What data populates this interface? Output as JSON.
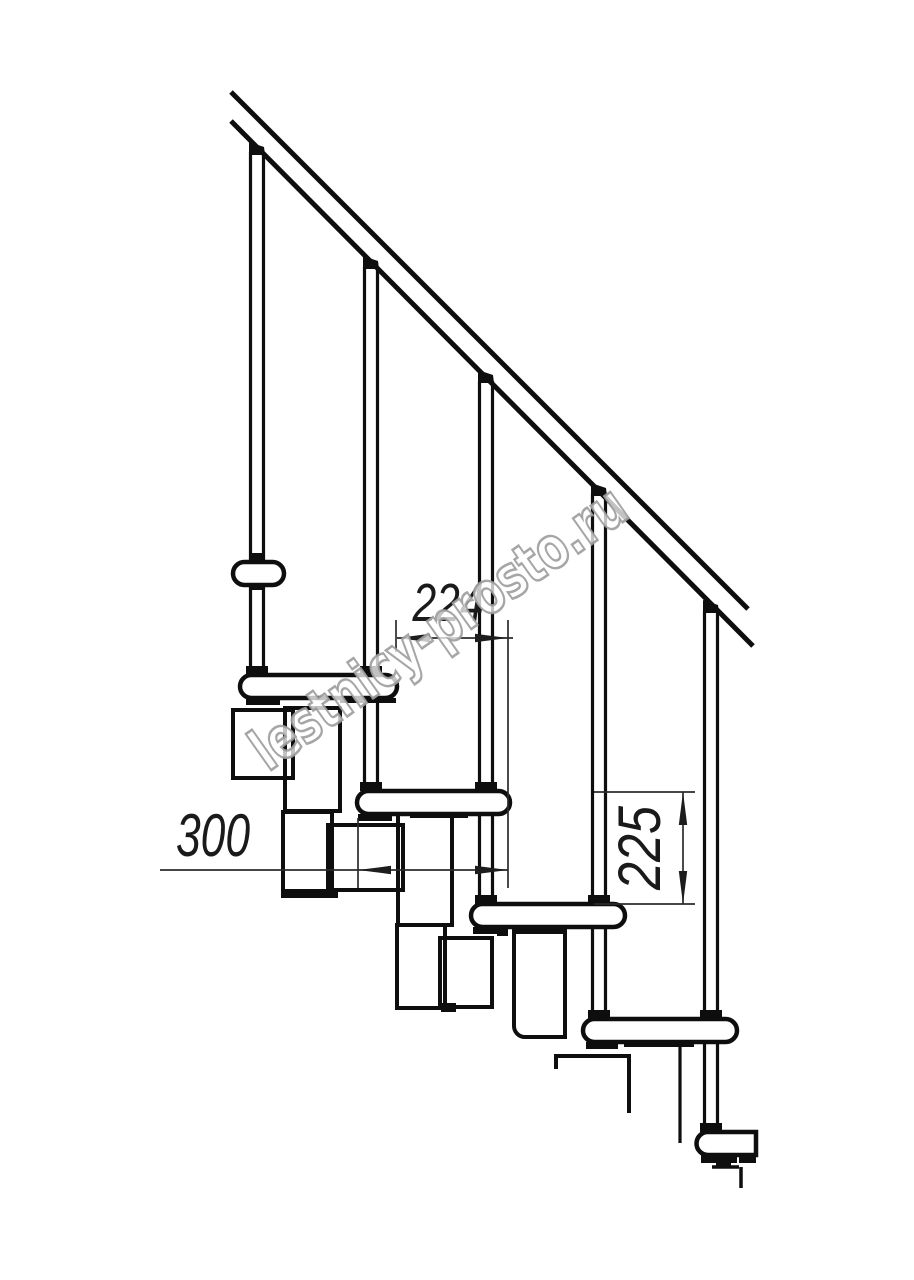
{
  "watermark": {
    "text": "lestnicy-prosto.ru"
  },
  "dimensions": {
    "step_run": {
      "label": "224"
    },
    "tread_depth": {
      "label": "300"
    },
    "step_rise": {
      "label": "225"
    }
  },
  "colors": {
    "background": "#ffffff",
    "line": "#0e0e0e",
    "dim_line": "#2b2b2b",
    "dim_text": "#1a1a1a",
    "watermark_fill": "#ffffff",
    "watermark_outline": "#9c9c9c"
  }
}
